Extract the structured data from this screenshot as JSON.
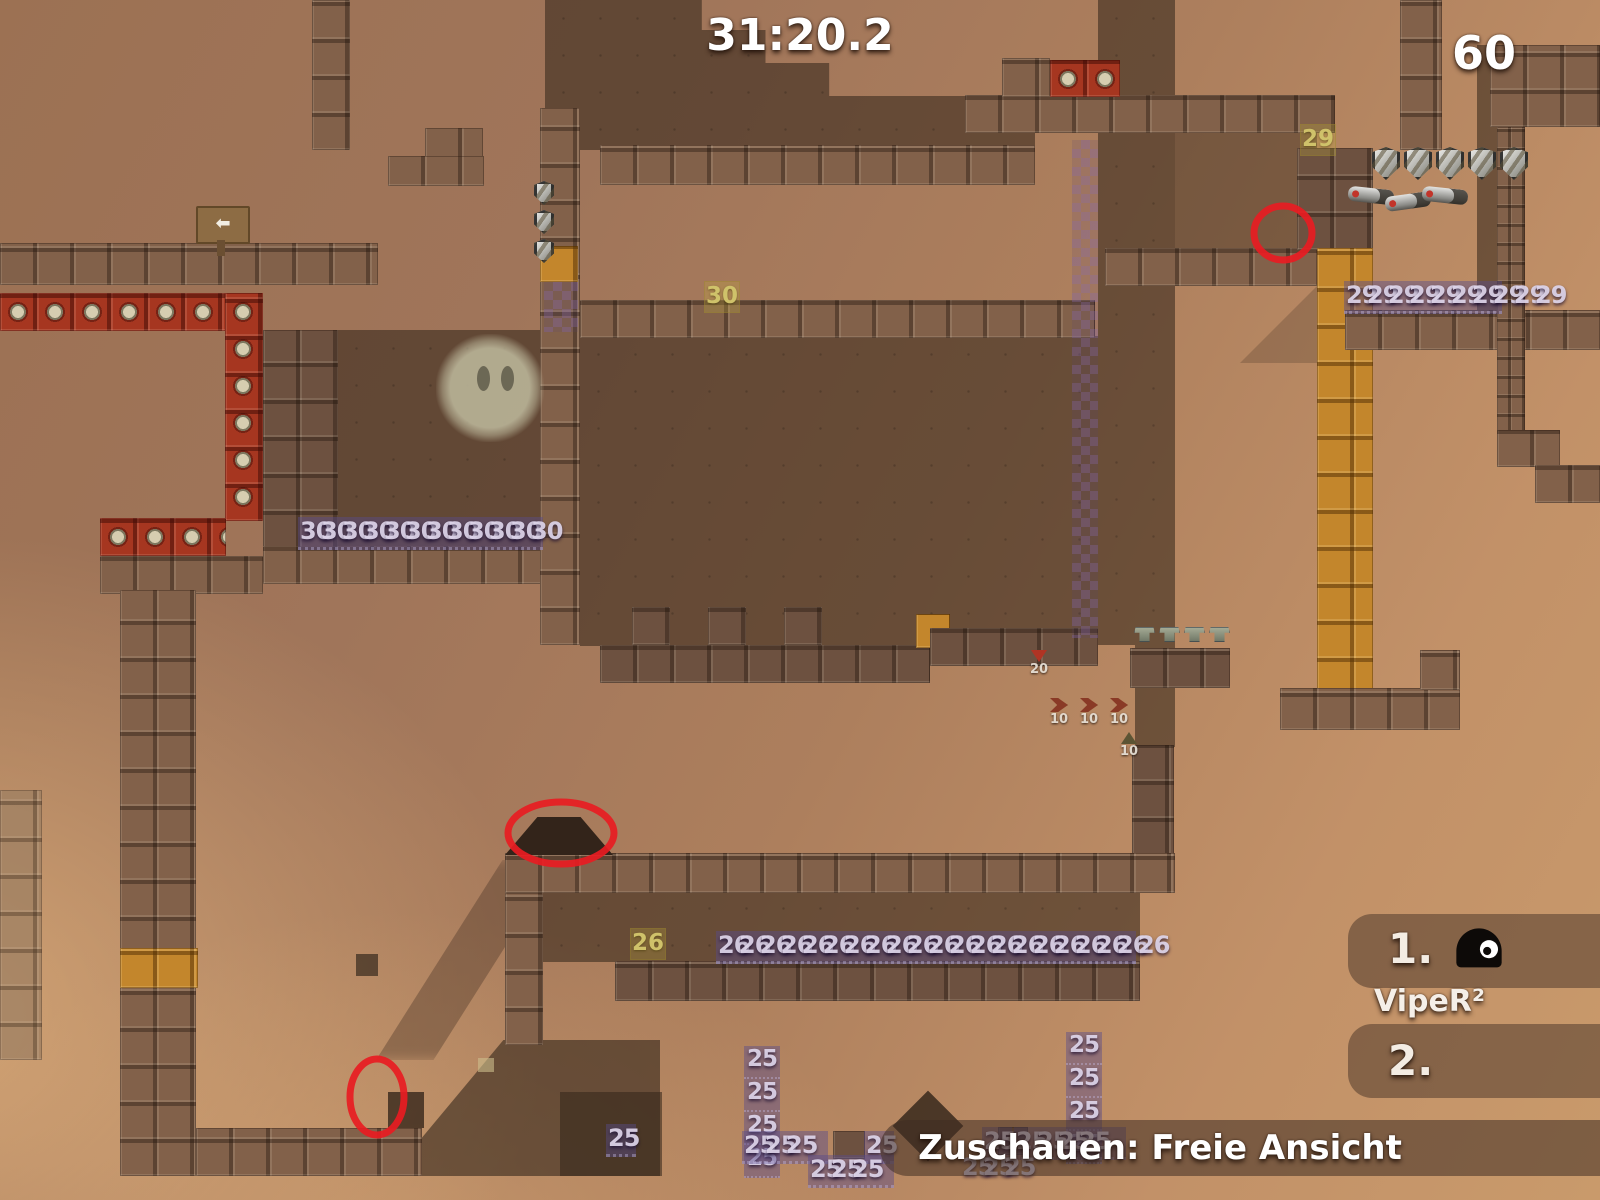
{
  "hud": {
    "timer": "31:20.2",
    "counter": "60",
    "spectator_bar": "Zuschauen: Freie Ansicht",
    "scoreboard": {
      "first_rank": "1.",
      "first_name": "VipeR²",
      "second_rank": "2."
    }
  },
  "map": {
    "tile_labels": [
      {
        "text": "30",
        "x": 704,
        "y": 281
      },
      {
        "text": "29",
        "x": 1300,
        "y": 124
      },
      {
        "text": "26",
        "x": 630,
        "y": 928
      }
    ],
    "timer_strips": [
      {
        "value": "30",
        "count": 12,
        "x": 300,
        "y": 519,
        "dir": "h",
        "bg": true,
        "bgw": 245
      },
      {
        "value": "29",
        "count": 10,
        "x": 1346,
        "y": 283,
        "dir": "h",
        "bg": true,
        "bgw": 158
      },
      {
        "value": "26",
        "count": 21,
        "x": 718,
        "y": 933,
        "dir": "h",
        "bg": true,
        "bgw": 420
      },
      {
        "value": "25",
        "count": 4,
        "x": 744,
        "y": 1046,
        "dir": "v"
      },
      {
        "value": "25",
        "count": 3,
        "x": 744,
        "y": 1133,
        "dir": "h",
        "bg": true,
        "bgw": 86
      },
      {
        "value": "25",
        "count": 1,
        "x": 866,
        "y": 1133,
        "dir": "h",
        "bg": true,
        "bgw": 30
      },
      {
        "value": "25",
        "count": 3,
        "x": 810,
        "y": 1157,
        "dir": "h",
        "bg": true,
        "bgw": 86
      },
      {
        "value": "25",
        "count": 4,
        "x": 1066,
        "y": 1032,
        "dir": "v"
      },
      {
        "value": "25",
        "count": 1,
        "x": 984,
        "y": 1129,
        "dir": "h",
        "bg": true,
        "bgw": 30
      },
      {
        "value": "25",
        "count": 4,
        "x": 1016,
        "y": 1129,
        "dir": "h",
        "bg": true,
        "bgw": 112
      },
      {
        "value": "25",
        "count": 3,
        "x": 962,
        "y": 1155,
        "dir": "h"
      },
      {
        "value": "25",
        "count": 1,
        "x": 608,
        "y": 1126,
        "dir": "h",
        "bg": true,
        "bgw": 30
      }
    ],
    "boosters": [
      {
        "value": "20",
        "x": 1026,
        "y": 650,
        "arrow": "down"
      },
      {
        "value": "10",
        "x": 1046,
        "y": 698,
        "arrow": "right"
      },
      {
        "value": "10",
        "x": 1076,
        "y": 698,
        "arrow": "right"
      },
      {
        "value": "10",
        "x": 1106,
        "y": 698,
        "arrow": "right"
      },
      {
        "value": "10",
        "x": 1116,
        "y": 732,
        "arrow": "up"
      }
    ],
    "pickups": {
      "armor_row": {
        "x": 1372,
        "y": 147,
        "count": 5,
        "dx": 32,
        "w": 28,
        "h": 33
      },
      "armor_col": {
        "x": 534,
        "y": 181,
        "count": 3,
        "dy": 29,
        "w": 20,
        "h": 24
      },
      "weapon_row": {
        "x": 1348,
        "y": 188,
        "count": 3,
        "dx": 37,
        "w": 46,
        "h": 15
      },
      "stool_row": {
        "x": 1134,
        "y": 627,
        "count": 4,
        "dx": 25,
        "w": 21,
        "h": 15
      }
    },
    "sign": {
      "arrow": "⬅"
    }
  },
  "annotations": {
    "circles": [
      {
        "cx": 1283,
        "cy": 233,
        "rx": 29,
        "ry": 27
      },
      {
        "cx": 561,
        "cy": 833,
        "rx": 53,
        "ry": 31
      },
      {
        "cx": 377,
        "cy": 1097,
        "rx": 27,
        "ry": 38
      }
    ]
  },
  "colors": {
    "annotation_red": "#e81c22",
    "hud_text": "#ffffff",
    "freeze_number": "#ded6ea",
    "label_yellow": "#cfc26a",
    "orange_tile": "#c3862c",
    "kill_tile_red": "#a63620"
  }
}
